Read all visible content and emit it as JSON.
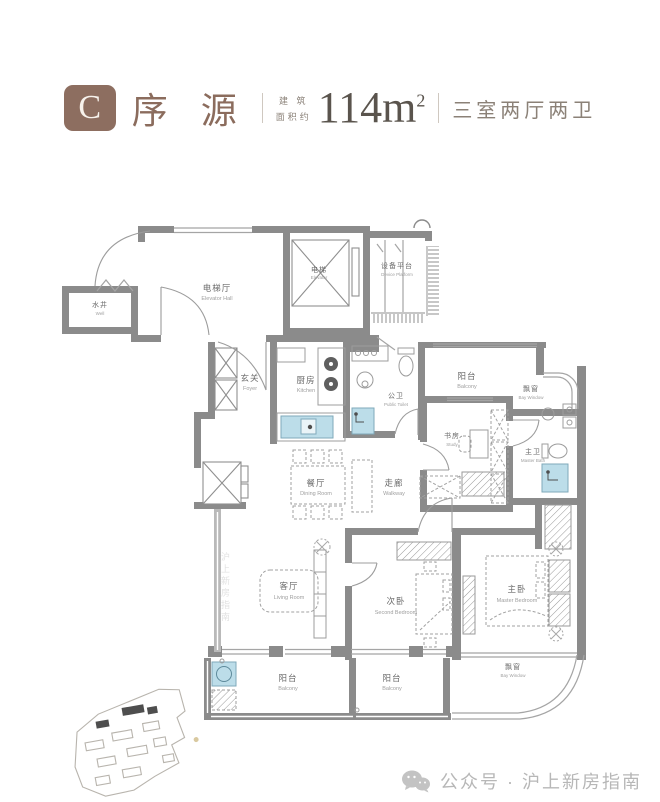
{
  "header": {
    "badge": "C",
    "type_name": "序 源",
    "area_label_line1": "建 筑",
    "area_label_line2": "面积约",
    "area_number": "114m",
    "area_sup": "2",
    "layout_text": "三室两厅两卫"
  },
  "colors": {
    "accent_brown": "#8d6e60",
    "wall_gray": "#8b8b8b",
    "fixture_blue": "#bcdde9",
    "watermark_gray": "#b7b7b7"
  },
  "floorplan": {
    "rooms": [
      {
        "id": "well",
        "cn": "水井",
        "en": "Well"
      },
      {
        "id": "elevator-hall",
        "cn": "电梯厅",
        "en": "Elevator Hall"
      },
      {
        "id": "elevator",
        "cn": "电梯",
        "en": "Elevator"
      },
      {
        "id": "device-platform",
        "cn": "设备平台",
        "en": "Device Platform"
      },
      {
        "id": "foyer",
        "cn": "玄关",
        "en": "Foyer"
      },
      {
        "id": "kitchen",
        "cn": "厨房",
        "en": "Kitchen"
      },
      {
        "id": "public-toilet",
        "cn": "公卫",
        "en": "Public Toilet"
      },
      {
        "id": "balcony-right",
        "cn": "阳台",
        "en": "Balcony"
      },
      {
        "id": "bay-window-right",
        "cn": "飘窗",
        "en": "Bay Window"
      },
      {
        "id": "study",
        "cn": "书房",
        "en": "Study"
      },
      {
        "id": "master-bath",
        "cn": "主卫",
        "en": "Master Bath"
      },
      {
        "id": "dining-room",
        "cn": "餐厅",
        "en": "Dining Room"
      },
      {
        "id": "walkway",
        "cn": "走廊",
        "en": "Walkway"
      },
      {
        "id": "living-room",
        "cn": "客厅",
        "en": "Living Room"
      },
      {
        "id": "second-bedroom",
        "cn": "次卧",
        "en": "Second Bedroom"
      },
      {
        "id": "master-bedroom",
        "cn": "主卧",
        "en": "Master Bedroom"
      },
      {
        "id": "bay-window-bottom",
        "cn": "飘窗",
        "en": "Bay Window"
      },
      {
        "id": "balcony-bottom-left",
        "cn": "阳台",
        "en": "Balcony"
      },
      {
        "id": "balcony-bottom-mid",
        "cn": "阳台",
        "en": "Balcony"
      }
    ]
  },
  "footer": {
    "label": "公众号 · 沪上新房指南"
  },
  "side_watermark": "沪上新房指南"
}
